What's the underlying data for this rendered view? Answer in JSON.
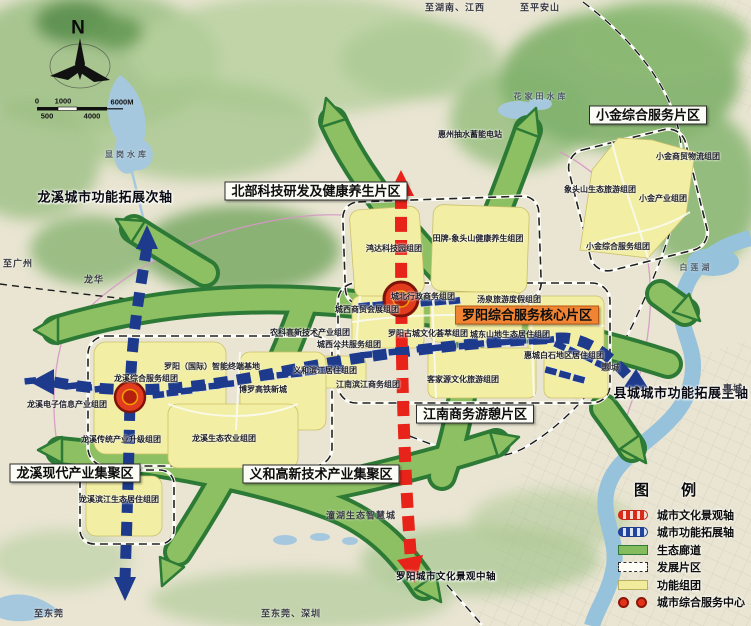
{
  "compass": {
    "north": "N"
  },
  "scalebar": {
    "zero": "0",
    "one_k": "1000",
    "six_k": "6000M",
    "five_h": "500",
    "four_k": "4000"
  },
  "regions": {
    "north": "北部科技研发及健康养生片区",
    "xiaojin": "小金综合服务片区",
    "luoyang_core": "罗阳综合服务核心片区",
    "jiangnan": "江南商务游憩片区",
    "yihe": "义和高新技术产业集聚区",
    "longxi": "龙溪现代产业集聚区"
  },
  "axes": {
    "longxi_secondary": "龙溪城市功能拓展次轴",
    "county_main": "县城城市功能拓展主轴",
    "luoyang_central": "罗阳城市文化景观中轴"
  },
  "clusters": {
    "hongda": "鸿达科技园组团",
    "tianpai": "田牌-象头山健康养生组团",
    "xj_trade": "小金商贸物流组团",
    "xts_tourism": "象头山生态旅游组团",
    "xj_industry": "小金产业组团",
    "xj_service": "小金综合服务组团",
    "chengbei": "城北行政商务组团",
    "tangquan": "汤泉旅游度假组团",
    "chengxi_trade": "城西商贸会展组团",
    "gucheng": "罗阳古城文化荟萃组团",
    "chengdong": "城东山地生态居住组团",
    "baishi": "惠城白石地区居住组团",
    "kejiayuan": "客家源文化旅游组团",
    "chengxi_public": "城西公共服务组团",
    "yihe_riverside": "义和滨江居住组团",
    "jiangnan_riverside": "江南滨江商务组团",
    "nongke": "农科高新技术产业组团",
    "terminal_base": "罗阳（国际）智能终端基地",
    "gaotie": "博罗高铁新城",
    "lx_service": "龙溪综合服务组团",
    "lx_electronics": "龙溪电子信息产业组团",
    "lx_upgrade": "龙溪传统产业升级组团",
    "lx_agri": "龙溪生态农业组团",
    "lx_riverside": "龙溪滨江生态居住组团",
    "pumped_storage": "惠州抽水蓄能电站"
  },
  "places": {
    "to_hunan": "至湖南、江西",
    "to_pinganshan": "至平安山",
    "to_guangzhou": "至广州",
    "longhua": "龙华",
    "huicheng_inner": "惠城",
    "huicheng_edge": "惠城",
    "to_dongguan": "至东莞",
    "to_dongguan_shenzhen": "至东莞、深圳",
    "tonghu": "潼湖生态智慧城",
    "xiangang_reservoir": "显岗水库",
    "huajiatian_reservoir": "花家田水库",
    "bailian_lake": "白莲湖"
  },
  "legend": {
    "title": "图 例",
    "items": [
      {
        "label": "城市文化景观轴",
        "symbol": "red-dashed-axis"
      },
      {
        "label": "城市功能拓展轴",
        "symbol": "blue-dashed-axis"
      },
      {
        "label": "生态廊道",
        "symbol": "green-corridor"
      },
      {
        "label": "发展片区",
        "symbol": "dashed-outline"
      },
      {
        "label": "功能组团",
        "symbol": "yellow-block"
      },
      {
        "label": "城市综合服务中心",
        "symbol": "red-circles"
      }
    ]
  },
  "colors": {
    "culture_axis": "#e8231a",
    "function_axis": "#1d3a8c",
    "eco_corridor": "#8dbf63",
    "cluster_fill": "#f2eea4",
    "service_center": "#e23b1d",
    "core_label_bg": "#f08433"
  }
}
